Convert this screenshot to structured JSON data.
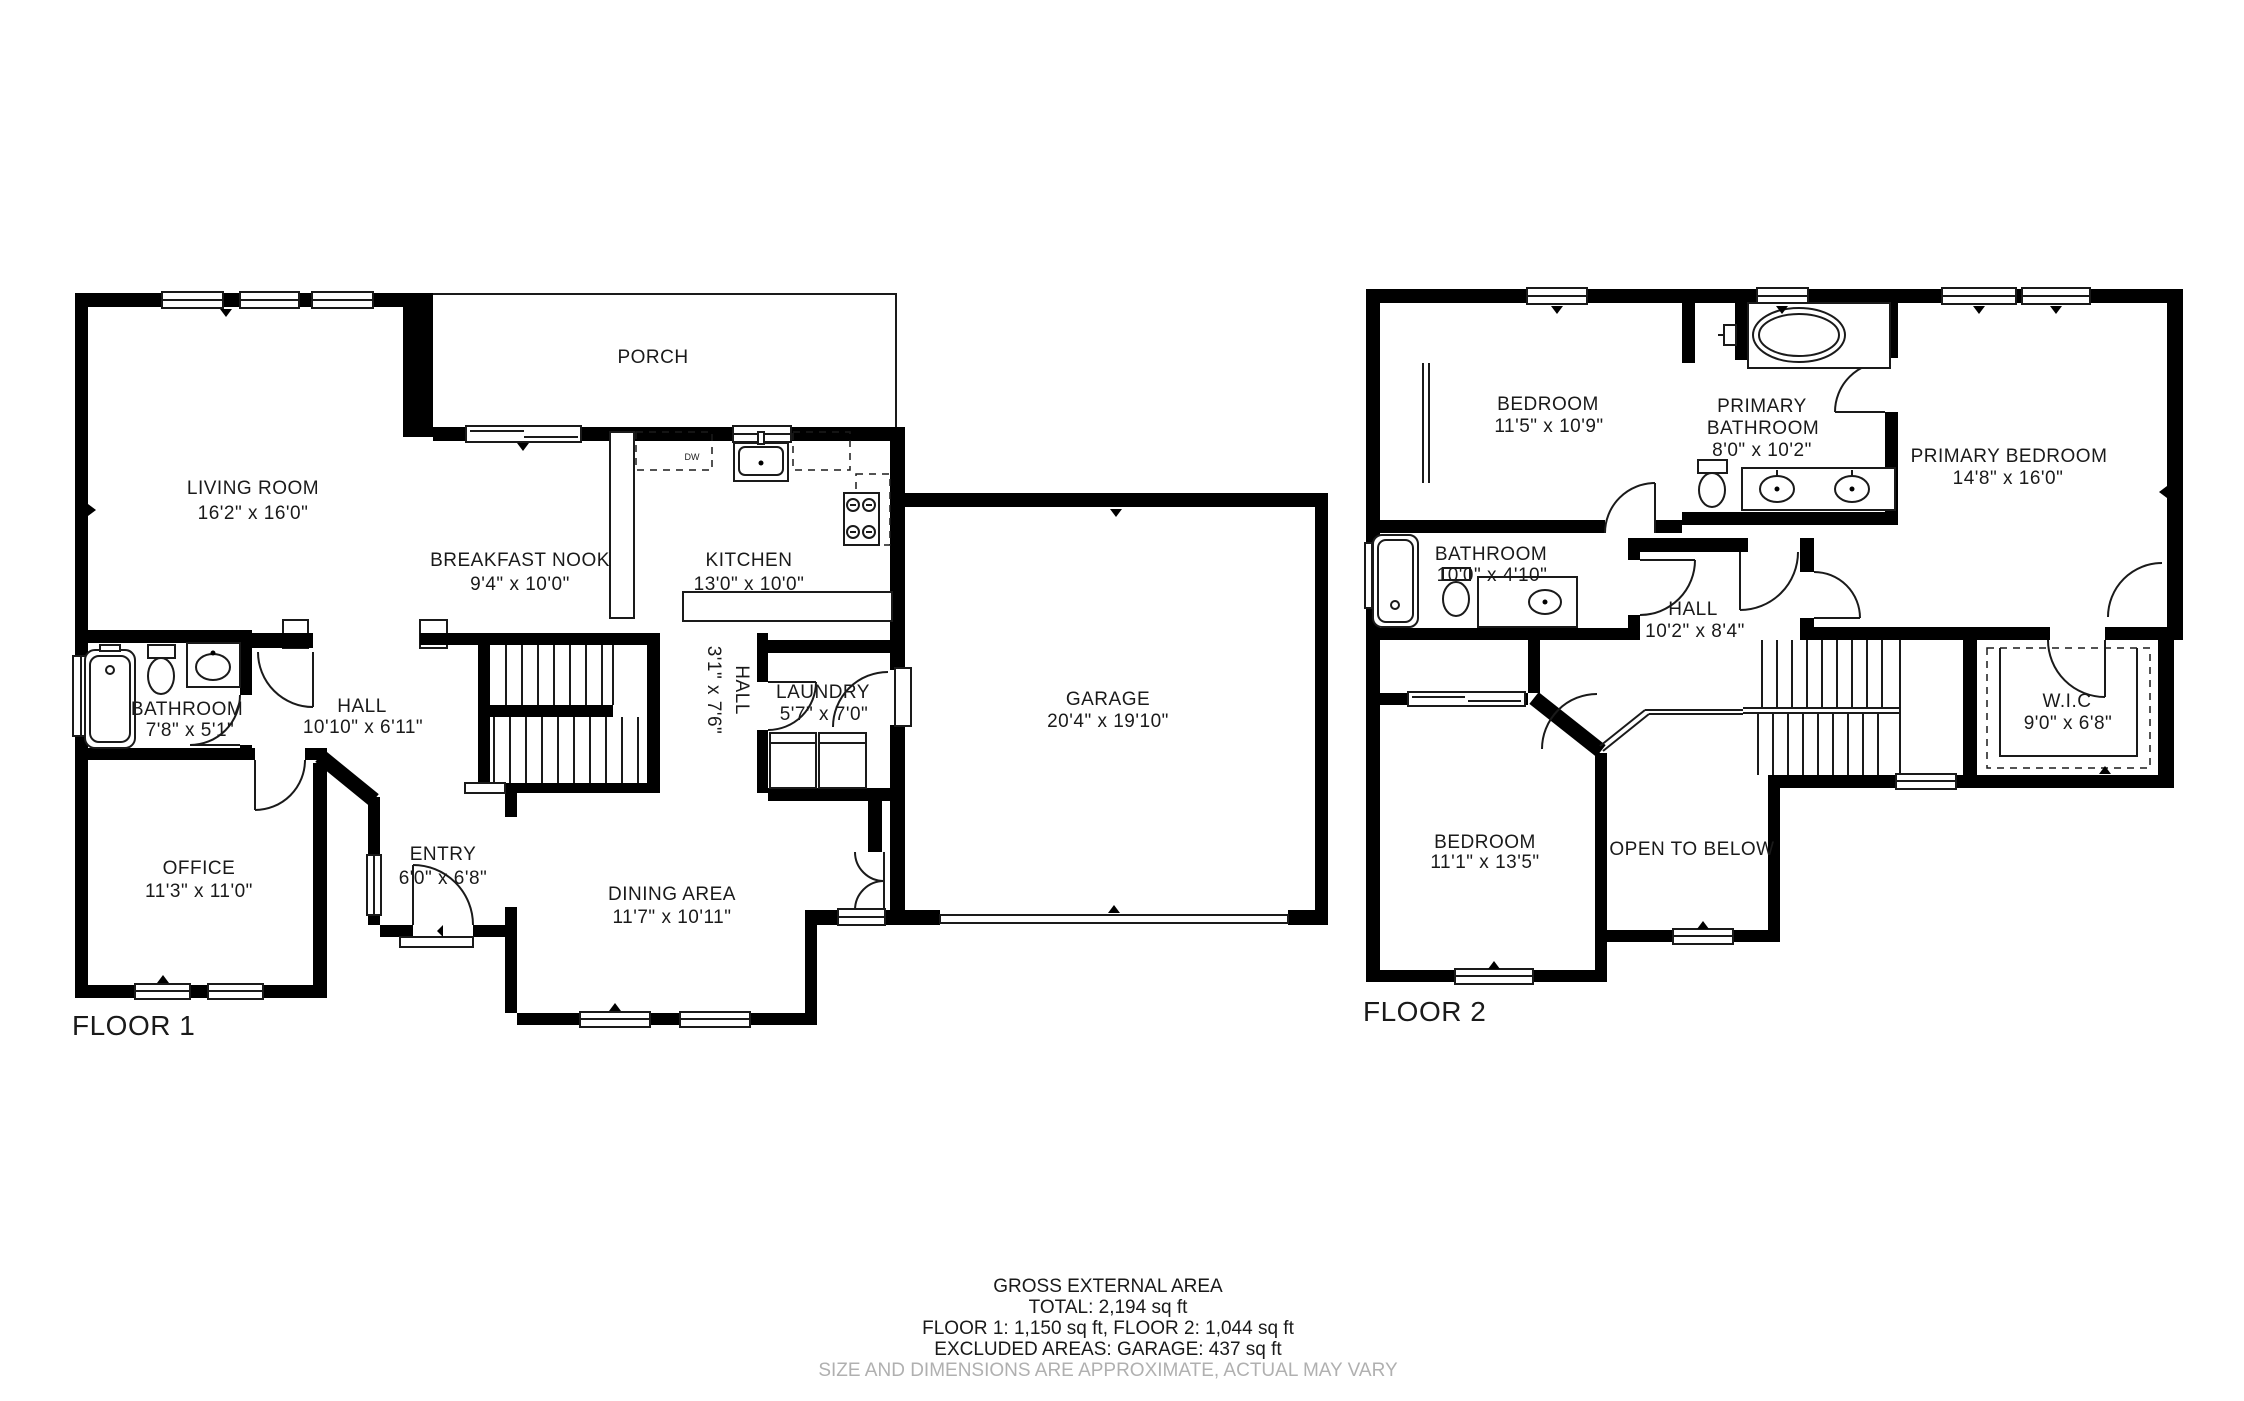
{
  "floor1": {
    "title": "FLOOR 1",
    "living": {
      "name": "LIVING ROOM",
      "dims": "16'2\" x 16'0\""
    },
    "porch": {
      "name": "PORCH"
    },
    "nook": {
      "name": "BREAKFAST NOOK",
      "dims": "9'4\" x 10'0\""
    },
    "kitchen": {
      "name": "KITCHEN",
      "dims": "13'0\" x 10'0\""
    },
    "dishwasher_label": "DW",
    "bathroom": {
      "name": "BATHROOM",
      "dims": "7'8\" x 5'1\""
    },
    "hall": {
      "name": "HALL",
      "dims": "10'10\" x 6'11\""
    },
    "hall_small": {
      "name": "HALL",
      "dims": "3'1\" x 7'6\""
    },
    "laundry": {
      "name": "LAUNDRY",
      "dims": "5'7\" x 7'0\""
    },
    "garage": {
      "name": "GARAGE",
      "dims": "20'4\" x 19'10\""
    },
    "office": {
      "name": "OFFICE",
      "dims": "11'3\" x 11'0\""
    },
    "entry": {
      "name": "ENTRY",
      "dims": "6'0\" x 6'8\""
    },
    "dining": {
      "name": "DINING AREA",
      "dims": "11'7\" x 10'11\""
    }
  },
  "floor2": {
    "title": "FLOOR 2",
    "bedroom1": {
      "name": "BEDROOM",
      "dims": "11'5\" x 10'9\""
    },
    "primary_bathroom": {
      "name_line1": "PRIMARY",
      "name_line2": "BATHROOM",
      "dims": "8'0\" x 10'2\""
    },
    "primary_bedroom": {
      "name": "PRIMARY BEDROOM",
      "dims": "14'8\" x 16'0\""
    },
    "bathroom": {
      "name": "BATHROOM",
      "dims": "10'0\" x 4'10\""
    },
    "hall": {
      "name": "HALL",
      "dims": "10'2\" x 8'4\""
    },
    "wic": {
      "name": "W.I.C",
      "dims": "9'0\" x 6'8\""
    },
    "bedroom2": {
      "name": "BEDROOM",
      "dims": "11'1\" x 13'5\""
    },
    "open_below": "OPEN TO BELOW"
  },
  "footer": {
    "line1": "GROSS EXTERNAL AREA",
    "line2": "TOTAL: 2,194 sq ft",
    "line3": "FLOOR 1: 1,150 sq ft, FLOOR 2: 1,044 sq ft",
    "line4": "EXCLUDED AREAS: GARAGE: 437 sq ft",
    "line5": "SIZE AND DIMENSIONS ARE APPROXIMATE, ACTUAL MAY VARY"
  }
}
